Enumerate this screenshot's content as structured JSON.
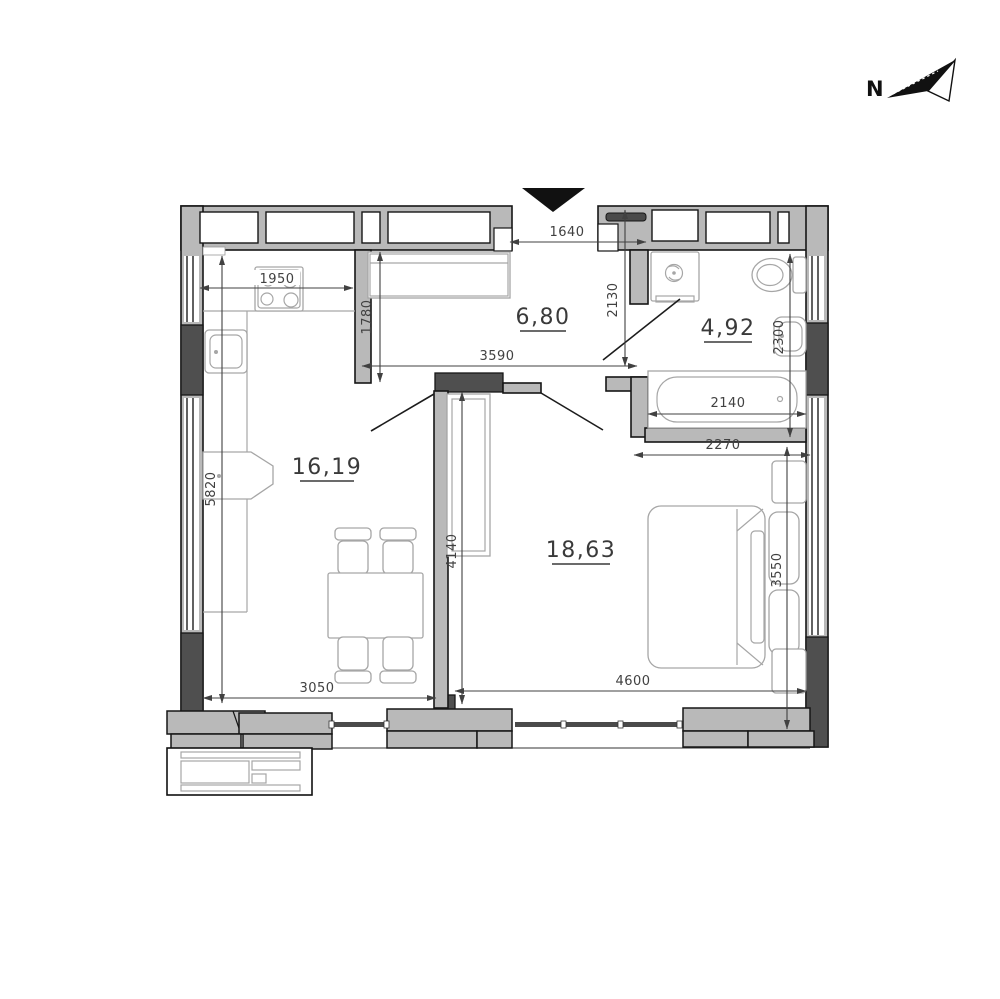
{
  "compass": {
    "label": "N"
  },
  "rooms": {
    "living_kitchen": {
      "area": "16,19"
    },
    "hallway": {
      "area": "6,80"
    },
    "bathroom": {
      "area": "4,92"
    },
    "bedroom": {
      "area": "18,63"
    }
  },
  "dimensions_mm": {
    "kitchen_run": "1950",
    "entry_width": "1640",
    "hall_left_wall": "1780",
    "hall_depth": "2130",
    "hall_width": "3590",
    "living_length": "5820",
    "partition_length": "4140",
    "bedroom_niche": "2270",
    "bathroom_depth": "2300",
    "bathtub_length": "2140",
    "bedroom_depth": "3550",
    "living_width": "3050",
    "bedroom_width": "4600"
  },
  "colors": {
    "wall": "#b9b9b9",
    "pillar": "#4f4f4f",
    "outline": "#161616",
    "dim": "#414141",
    "furn": "#a6a6a6"
  }
}
